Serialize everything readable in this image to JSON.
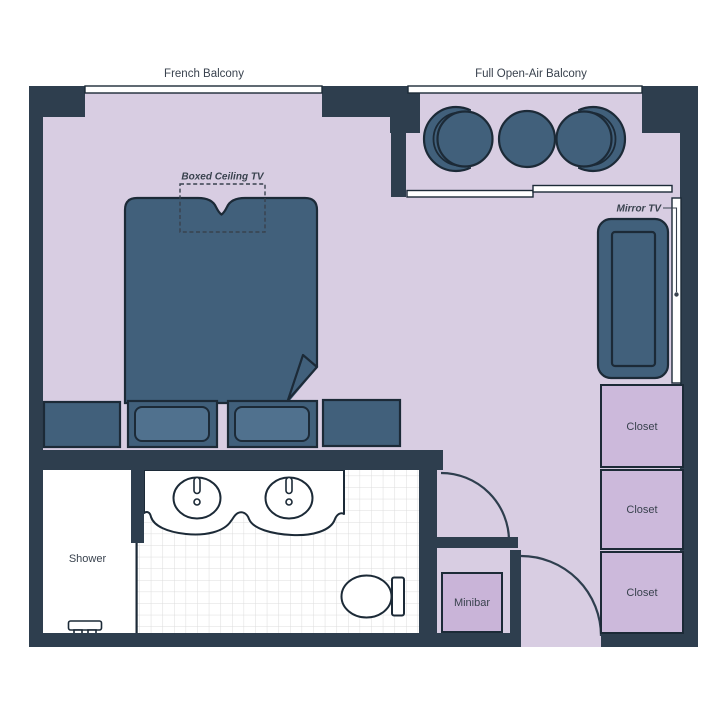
{
  "labels": {
    "french_balcony": "French Balcony",
    "full_open_air_balcony": "Full Open-Air Balcony",
    "boxed_ceiling_tv": "Boxed Ceiling TV",
    "mirror_tv": "Mirror TV",
    "shower": "Shower",
    "minibar": "Minibar",
    "closet_top": "Closet",
    "closet_middle": "Closet",
    "closet_bottom": "Closet"
  },
  "colors": {
    "wall": "#2e3e4e",
    "furniture": "#41607b",
    "pillow": "#50718e",
    "floor": "#d8cde2",
    "closet": "#ccb9db",
    "minibar": "#c9b4d8",
    "outline": "#1c2a37",
    "text": "#39424e",
    "tile_line": "#dcdcdc",
    "white": "#ffffff"
  }
}
